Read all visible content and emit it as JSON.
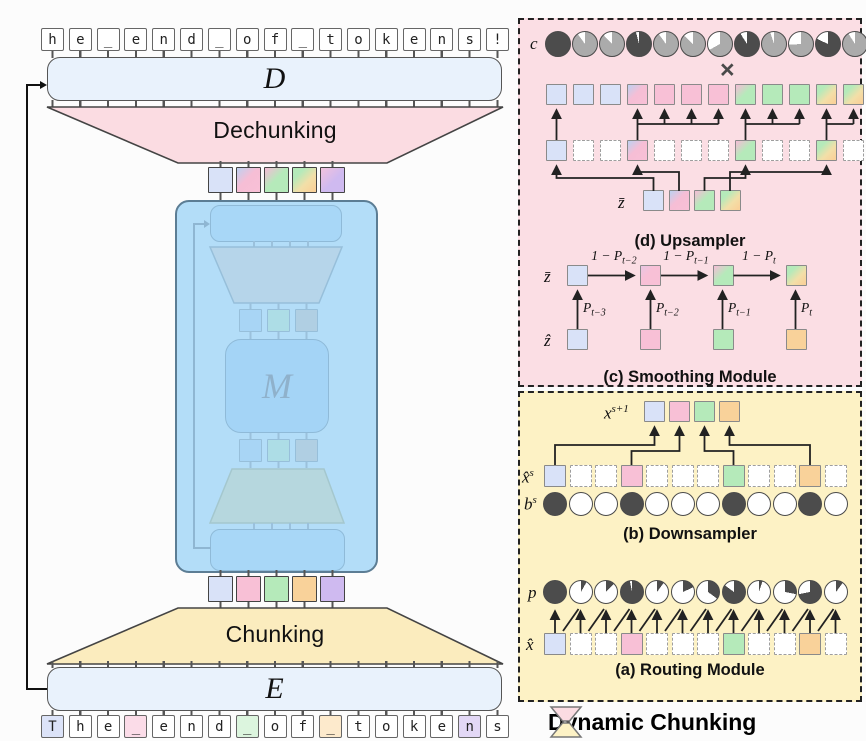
{
  "colors": {
    "blue": "#d9e2f8",
    "pink": "#f8c0d6",
    "green": "#b5eaba",
    "orange": "#f9d29a",
    "purple": "#cfbaf0",
    "tok_blue": "#dce3f8",
    "tok_pink": "#fbdce8",
    "tok_green": "#dcf5de",
    "tok_orange": "#fdeacc",
    "tok_purple": "#e3d8f6",
    "pie_dark": "#4c4c4c",
    "pie_gray": "#ababab",
    "panel_pink": "#fbdee4",
    "panel_yellow": "#fdf2c5",
    "dechunk_fill": "#fbdce2",
    "chunk_fill": "#fbecbe",
    "inner_blue": "#9fcef3",
    "inner_teal": "#a9ddd6",
    "inner_gray": "#afc4d0"
  },
  "gradients": {
    "pink_blue": "linear-gradient(135deg,#bdd1f1 0%,#f6bed5 45%,#f8c0d6 100%)",
    "green_pink": "linear-gradient(135deg,#f5bcd7 0%,#b5eaba 48%)",
    "green_orange": "linear-gradient(135deg,#b5eaba 25%,#f2dfa8 60%,#f9d29a 90%)",
    "purple_pink": "linear-gradient(135deg,#f2c2dc 0%,#cfbaf0 55%)",
    "pink_soft": "linear-gradient(135deg,#e8c6e2 0%,#f8c0d6 40%)"
  },
  "main": {
    "decoder_label": "D",
    "encoder_label": "E",
    "main_label": "M",
    "dechunking_label": "Dechunking",
    "chunking_label": "Chunking",
    "top_tokens": [
      "h",
      "e",
      "_",
      "e",
      "n",
      "d",
      "_",
      "o",
      "f",
      "_",
      "t",
      "o",
      "k",
      "e",
      "n",
      "s",
      "!"
    ],
    "bottom_tokens": [
      {
        "ch": "T",
        "color": "tok_blue"
      },
      {
        "ch": "h"
      },
      {
        "ch": "e"
      },
      {
        "ch": "_",
        "color": "tok_pink"
      },
      {
        "ch": "e"
      },
      {
        "ch": "n"
      },
      {
        "ch": "d"
      },
      {
        "ch": "_",
        "color": "tok_green"
      },
      {
        "ch": "o"
      },
      {
        "ch": "f"
      },
      {
        "ch": "_",
        "color": "tok_orange"
      },
      {
        "ch": "t"
      },
      {
        "ch": "o"
      },
      {
        "ch": "k"
      },
      {
        "ch": "e"
      },
      {
        "ch": "n",
        "color": "tok_purple"
      },
      {
        "ch": "s"
      }
    ],
    "chunks_top": [
      "blue",
      "pink_blue",
      "green_pink",
      "green_orange",
      "purple_pink"
    ],
    "chunks_bottom": [
      "blue",
      "pink",
      "green",
      "orange",
      "purple"
    ]
  },
  "upsampler": {
    "caption": "(d) Upsampler",
    "c_label": "c",
    "times_symbol": "×",
    "zbar_label": "z̄",
    "c_pies": [
      {
        "base": "dark",
        "white": 0.0
      },
      {
        "base": "gray",
        "white": 0.1
      },
      {
        "base": "gray",
        "white": 0.12
      },
      {
        "base": "dark",
        "white": 0.04
      },
      {
        "base": "gray",
        "white": 0.1
      },
      {
        "base": "gray",
        "white": 0.13
      },
      {
        "base": "gray",
        "white": 0.33
      },
      {
        "base": "dark",
        "white": 0.09
      },
      {
        "base": "gray",
        "white": 0.05
      },
      {
        "base": "gray",
        "white": 0.26
      },
      {
        "base": "dark",
        "white": 0.18
      },
      {
        "base": "gray",
        "white": 0.09
      }
    ],
    "out_row": [
      "blue",
      "blue",
      "blue",
      "pink_blue",
      "pink",
      "pink",
      "pink",
      "green_pink",
      "green",
      "green",
      "green_orange",
      "green_orange"
    ],
    "mid_row": [
      "blue",
      null,
      null,
      "pink_blue",
      null,
      null,
      null,
      "green_pink",
      null,
      null,
      "green_orange",
      null
    ],
    "zbar_row": [
      "blue",
      "pink_blue",
      "green_pink",
      "green_orange"
    ]
  },
  "smoothing": {
    "caption": "(c) Smoothing Module",
    "zbar_label": "z̄",
    "zhat_label": "ẑ",
    "zbar_row": [
      "blue",
      "pink_soft",
      "green_pink",
      "green_orange"
    ],
    "zhat_row": [
      "blue",
      "pink",
      "green",
      "orange"
    ],
    "h_labels": [
      {
        "pre": "1 − P",
        "sub": "t−2"
      },
      {
        "pre": "1 − P",
        "sub": "t−1"
      },
      {
        "pre": "1 − P",
        "sub": "t"
      }
    ],
    "v_labels": [
      {
        "pre": "P",
        "sub": "t−3"
      },
      {
        "pre": "P",
        "sub": "t−2"
      },
      {
        "pre": "P",
        "sub": "t−1"
      },
      {
        "pre": "P",
        "sub": "t"
      }
    ]
  },
  "downsampler": {
    "caption": "(b) Downsampler",
    "x_next_label": {
      "base": "x",
      "sup": "s+1"
    },
    "x_hat_label": {
      "base": "x̂",
      "sup": "s"
    },
    "b_label": {
      "base": "b",
      "sup": "s"
    },
    "x_next_row": [
      "blue",
      "pink",
      "green",
      "orange"
    ],
    "x_hat_row": [
      "blue",
      null,
      null,
      "pink",
      null,
      null,
      null,
      "green",
      null,
      null,
      "orange",
      null
    ],
    "b_row": [
      1,
      0,
      0,
      1,
      0,
      0,
      0,
      1,
      0,
      0,
      1,
      0
    ]
  },
  "routing": {
    "caption": "(a) Routing Module",
    "p_label": "p",
    "x_hat_label": "x̂",
    "p_values": [
      1.0,
      0.08,
      0.12,
      0.97,
      0.1,
      0.18,
      0.35,
      0.85,
      0.05,
      0.28,
      0.72,
      0.1
    ],
    "x_hat_row": [
      "blue",
      null,
      null,
      "pink",
      null,
      null,
      null,
      "green",
      null,
      null,
      "orange",
      null
    ]
  },
  "legend": {
    "label": "Dynamic Chunking"
  }
}
